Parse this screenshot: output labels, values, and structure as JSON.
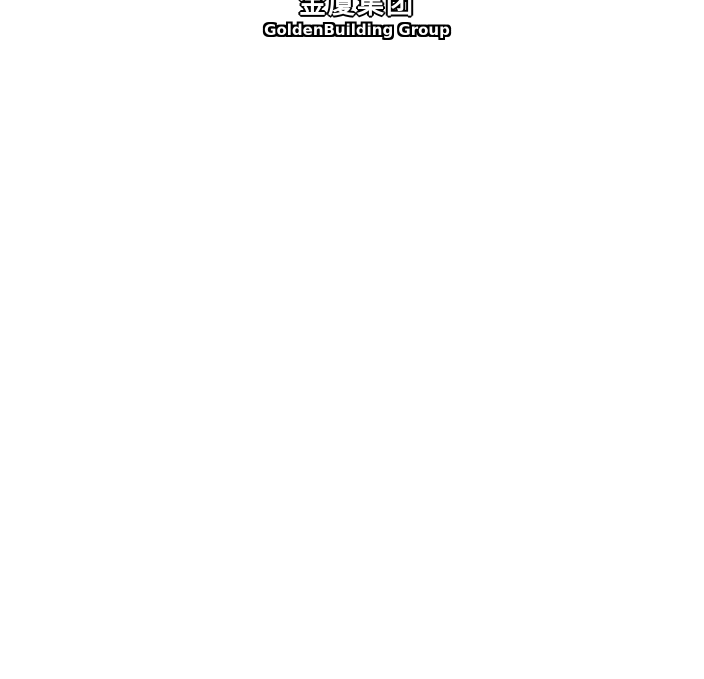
{
  "page": {
    "background_color": "#ffffff"
  },
  "header": {
    "logo": {
      "title_zh": "金厦集团",
      "subtitle_en": "GoldenBuilding Group",
      "text_color": "#ffffff",
      "outline_color": "#000000"
    }
  }
}
